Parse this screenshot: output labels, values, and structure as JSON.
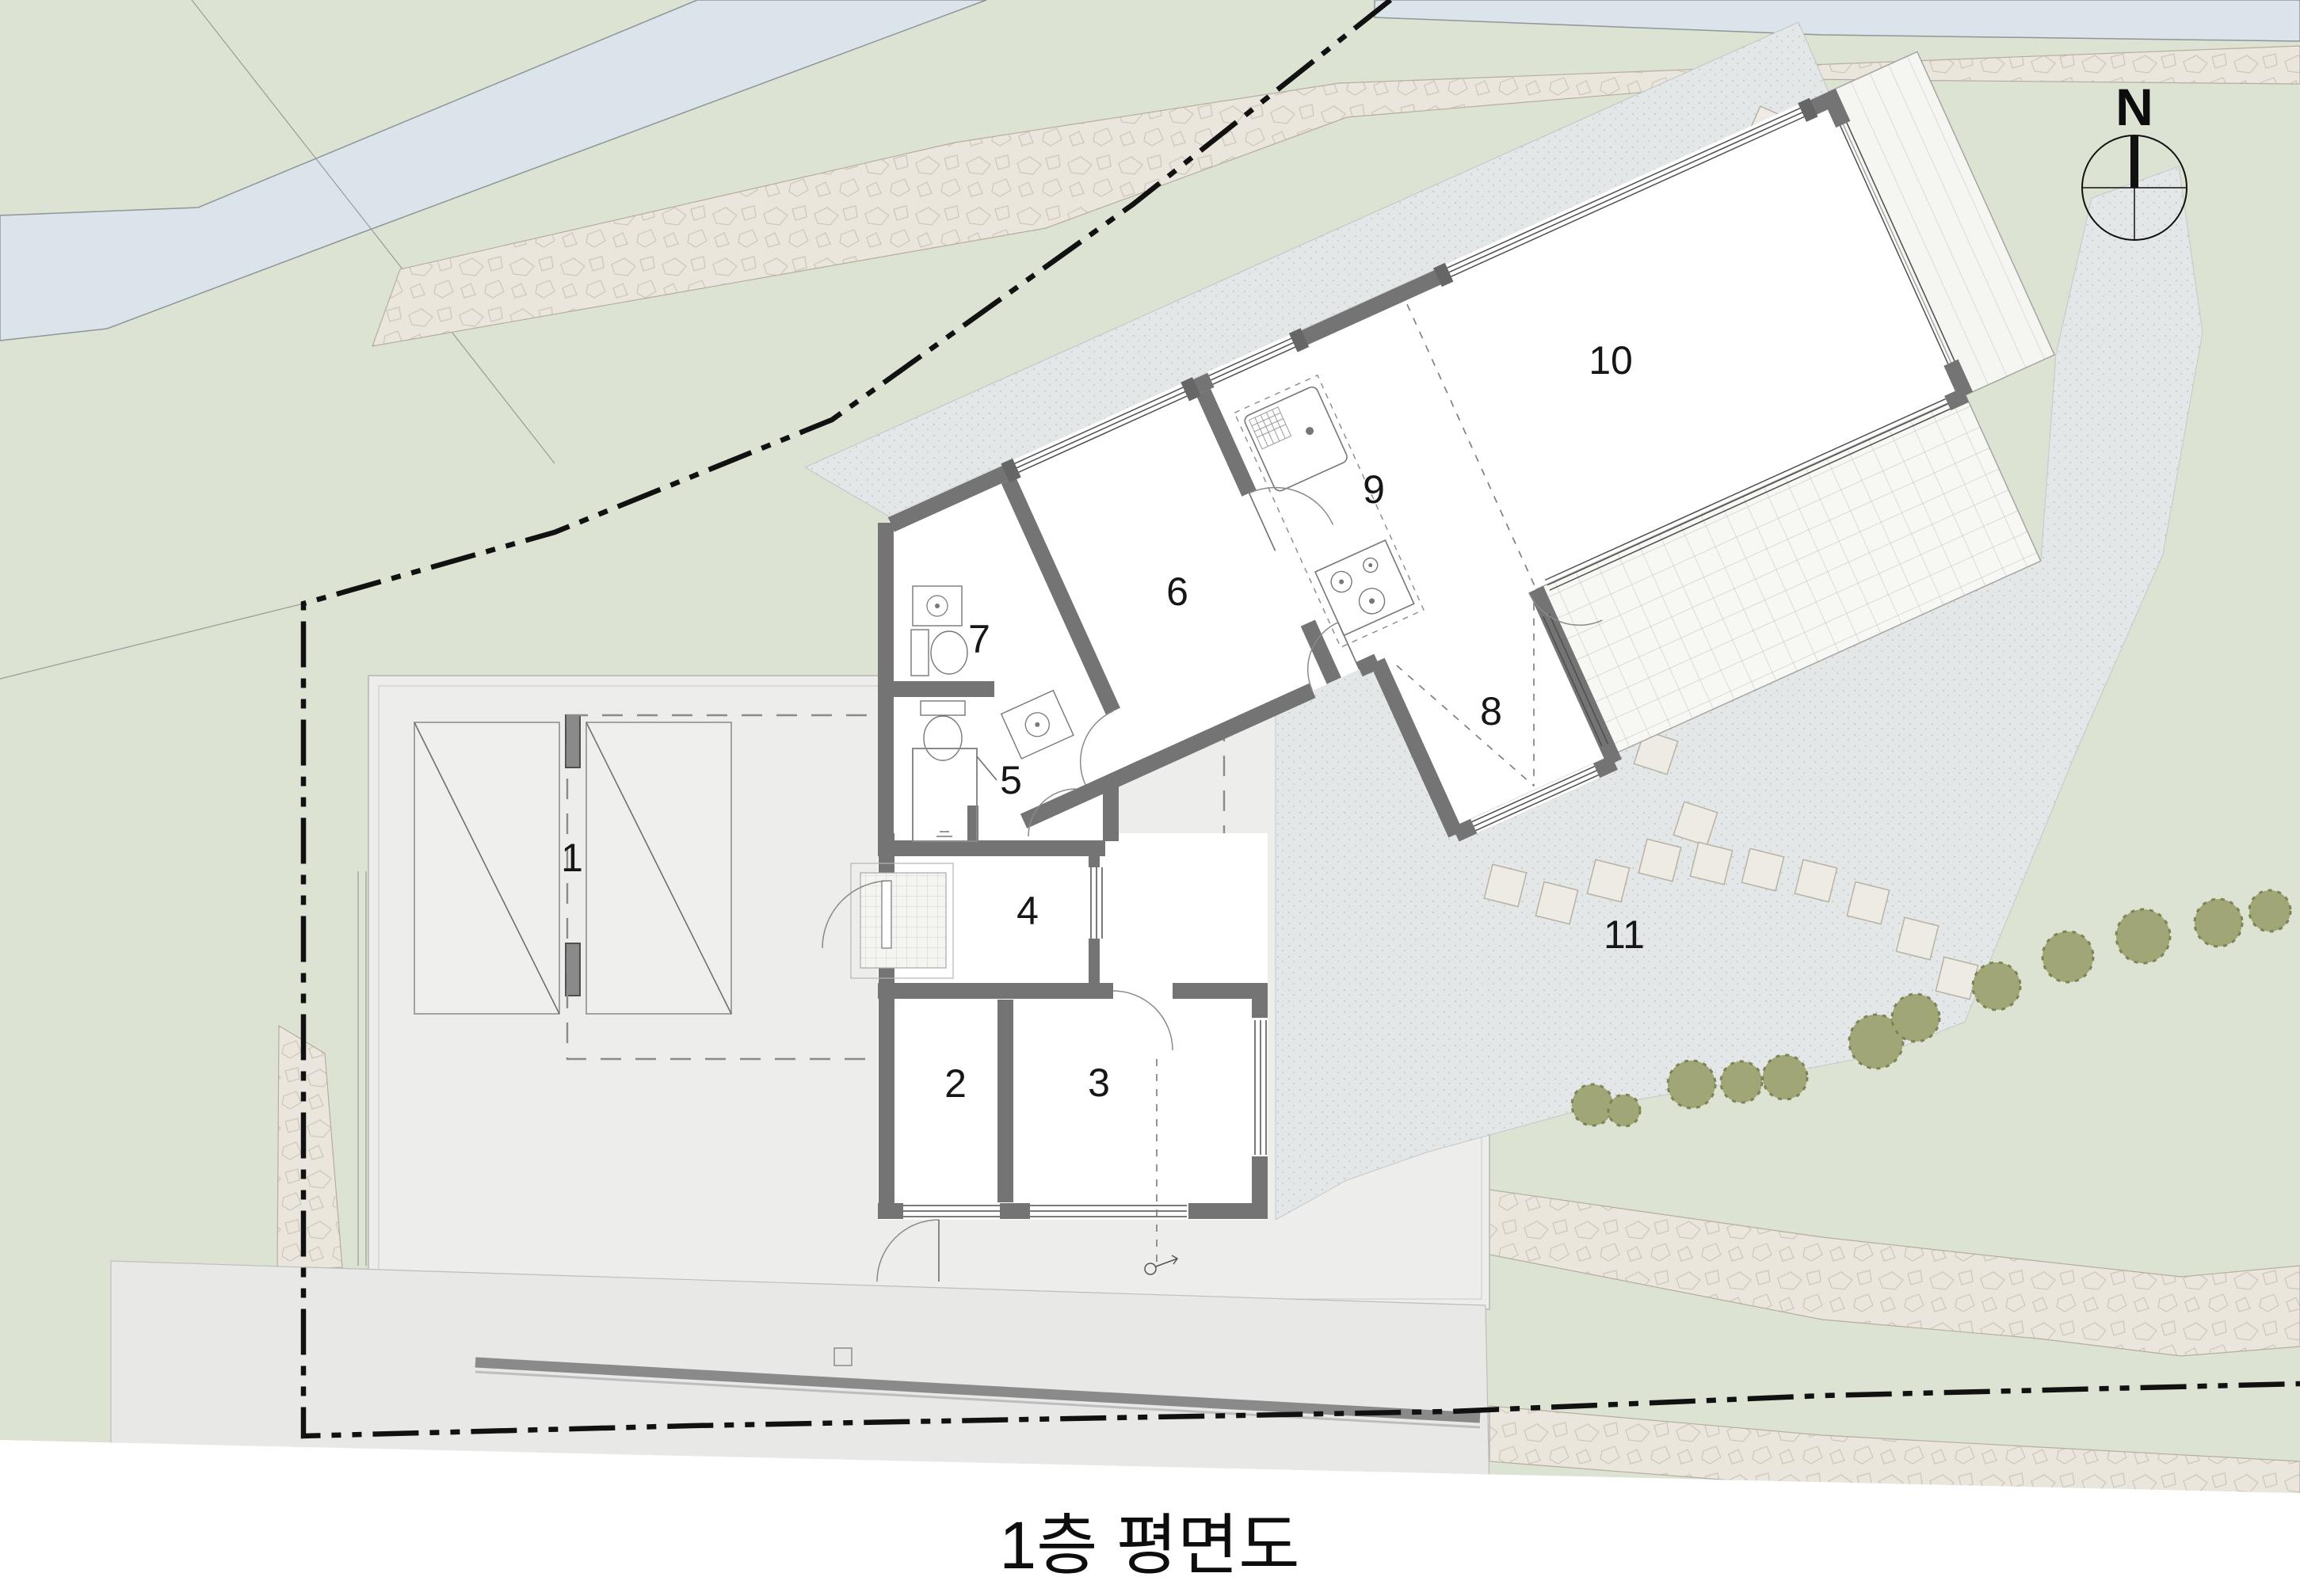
{
  "title": {
    "text": "1층 평면도"
  },
  "compass": {
    "label": "N"
  },
  "room_labels": [
    "1",
    "2",
    "3",
    "4",
    "5",
    "6",
    "7",
    "8",
    "9",
    "10",
    "11"
  ],
  "palette": {
    "lawn": "#dde3d2",
    "water": "#dce4eb",
    "stone_path": "#eae6dd",
    "gravel": "#e3e7e7",
    "pavement": "#ededec",
    "road": "#e8e8e6",
    "wall": "#747474",
    "tile": "#f7f7f4",
    "shrub": "#9aa06f",
    "boundary": "#111111",
    "label": "#161616"
  }
}
